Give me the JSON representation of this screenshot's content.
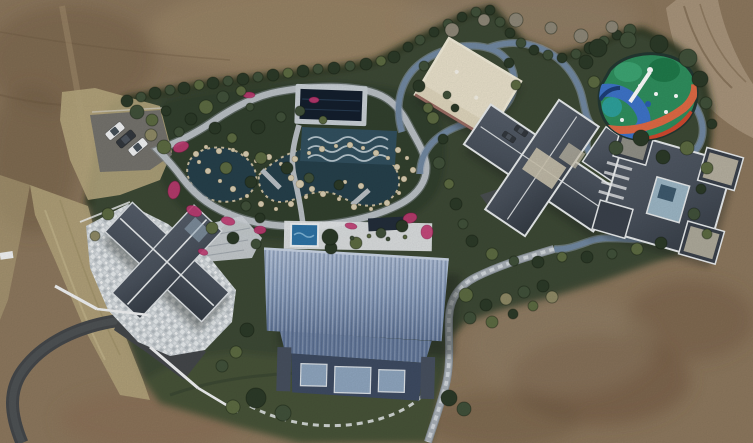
{
  "meta": {
    "type": "aerial-drone-photograph",
    "description": "Top-down drone view of a landscaped private estate surrounded by bare graded earth: a water garden with ponds and pink azaleas, a covered pool, a large blue metal-roof barn house, a slate-roof courtyard house with driveway and three parked cars, two dark hip-roof villas, a cream flat-roof pavilion, a colorful children's playground, winding grey and blue-grey paths, hedges and shrubs, a dirt road at top right and an asphalt road at bottom left."
  },
  "palette": {
    "dirt_base": "#8d785e",
    "dirt_light": "#a5906f",
    "dirt_dark": "#6b573f",
    "dirt_bottom": "#8a7057",
    "dirt_shadow": "#6e543c",
    "dirt_gray": "#94836c",
    "road_dirt": "#a8947b",
    "asphalt": "#44474a",
    "road_sheen": "#5c5f61",
    "parking": "#75736d",
    "grass_dry": "#b6a77e",
    "hedge": "#27321f",
    "green_base": "#3d4935",
    "green_dark": "#333f2d",
    "lawn": "#465339",
    "path_light": "#bac0c5",
    "path_blue": "#7289a2",
    "path_stone": "#aab1b8",
    "water": "#26404b",
    "wave_pool": "#32505f",
    "pool_cover": "#141f2d",
    "pool_frame": "#c9d0d5",
    "spa_blue": "#2e73a5",
    "roof_blue": "#8ba0c0",
    "roof_blue_light": "#a9bad4",
    "roof_blue_dark": "#64799c",
    "facade": "#3e4b62",
    "window_blue": "#8fa6bf",
    "slate": "#4a525d",
    "slate_dark": "#3a414b",
    "ridge": "#e9eced",
    "stone_pale": "#cfd5d9",
    "cream": "#e9e1cb",
    "cream_shade": "#d9cfb4",
    "glass": "#9db7c6",
    "tan_roof": "#ccc4af",
    "flower": "#c23a72",
    "rock": "#d7ccb1",
    "tree_dark": "#2c3a28",
    "tree_mid": "#41513a",
    "tree_olive": "#5d6b42",
    "tree_light": "#72814f",
    "tree_tan": "#8f8a66",
    "tree_bare": "#8e8878",
    "white": "#f2f3f4",
    "car_dark": "#33383e",
    "play_base": "#2f8f5e",
    "play_green": "#1f7a4a",
    "play_green2": "#3da573",
    "play_blue": "#3e74c9",
    "play_teal": "#2fa3a3",
    "play_orange": "#e06a45",
    "play_red": "#d0492f",
    "play_navy": "#1d3f7a"
  },
  "scene": {
    "regions": [
      "bare-earth",
      "dirt-road",
      "estate-garden",
      "water-garden",
      "covered-pool",
      "spa-deck",
      "blue-roof-barn",
      "courtyard-house",
      "villa-center",
      "villa-east",
      "cream-pavilion",
      "playground",
      "parking-lot",
      "asphalt-road",
      "south-lawn"
    ]
  },
  "vegetation": [
    [
      127,
      101,
      6,
      "dark"
    ],
    [
      141,
      97,
      5,
      "mid"
    ],
    [
      155,
      93,
      6,
      "dark"
    ],
    [
      170,
      90,
      5,
      "mid"
    ],
    [
      184,
      88,
      6,
      "dark"
    ],
    [
      199,
      85,
      5,
      "olive"
    ],
    [
      213,
      83,
      6,
      "dark"
    ],
    [
      228,
      81,
      5,
      "mid"
    ],
    [
      243,
      79,
      6,
      "dark"
    ],
    [
      258,
      77,
      5,
      "mid"
    ],
    [
      273,
      75,
      6,
      "dark"
    ],
    [
      288,
      73,
      5,
      "olive"
    ],
    [
      303,
      71,
      6,
      "dark"
    ],
    [
      318,
      69,
      5,
      "mid"
    ],
    [
      334,
      68,
      6,
      "dark"
    ],
    [
      350,
      66,
      5,
      "mid"
    ],
    [
      366,
      64,
      6,
      "dark"
    ],
    [
      381,
      61,
      5,
      "olive"
    ],
    [
      394,
      57,
      6,
      "dark"
    ],
    [
      408,
      47,
      5,
      "dark"
    ],
    [
      420,
      40,
      5,
      "mid"
    ],
    [
      434,
      32,
      5,
      "dark"
    ],
    [
      448,
      24,
      5,
      "mid"
    ],
    [
      462,
      17,
      5,
      "dark"
    ],
    [
      476,
      12,
      5,
      "mid"
    ],
    [
      490,
      10,
      5,
      "dark"
    ],
    [
      500,
      22,
      5,
      "mid"
    ],
    [
      510,
      33,
      5,
      "dark"
    ],
    [
      521,
      43,
      5,
      "mid"
    ],
    [
      534,
      50,
      5,
      "dark"
    ],
    [
      548,
      55,
      5,
      "mid"
    ],
    [
      562,
      58,
      5,
      "dark"
    ],
    [
      576,
      54,
      5,
      "mid"
    ],
    [
      590,
      48,
      6,
      "dark"
    ],
    [
      604,
      41,
      5,
      "mid"
    ],
    [
      617,
      35,
      5,
      "dark"
    ],
    [
      630,
      30,
      6,
      "mid"
    ],
    [
      452,
      30,
      7,
      "bare"
    ],
    [
      484,
      20,
      6,
      "bare"
    ],
    [
      516,
      20,
      7,
      "bare"
    ],
    [
      551,
      28,
      6,
      "bare"
    ],
    [
      581,
      36,
      7,
      "bare"
    ],
    [
      612,
      27,
      6,
      "bare"
    ],
    [
      137,
      112,
      7,
      "mid"
    ],
    [
      152,
      120,
      6,
      "olive"
    ],
    [
      166,
      111,
      5,
      "dark"
    ],
    [
      151,
      135,
      6,
      "tan"
    ],
    [
      164,
      147,
      7,
      "olive"
    ],
    [
      179,
      132,
      5,
      "mid"
    ],
    [
      191,
      119,
      6,
      "dark"
    ],
    [
      206,
      107,
      7,
      "olive"
    ],
    [
      223,
      97,
      6,
      "mid"
    ],
    [
      241,
      91,
      5,
      "olive"
    ],
    [
      215,
      128,
      6,
      "dark"
    ],
    [
      232,
      138,
      5,
      "olive"
    ],
    [
      258,
      127,
      7,
      "dark"
    ],
    [
      281,
      117,
      5,
      "mid"
    ],
    [
      261,
      158,
      6,
      "olive"
    ],
    [
      287,
      168,
      6,
      "dark"
    ],
    [
      309,
      178,
      5,
      "mid"
    ],
    [
      251,
      182,
      6,
      "dark"
    ],
    [
      226,
      168,
      6,
      "olive"
    ],
    [
      339,
      185,
      5,
      "dark"
    ],
    [
      300,
      111,
      5,
      "mid"
    ],
    [
      323,
      120,
      4,
      "olive"
    ],
    [
      212,
      228,
      6,
      "olive"
    ],
    [
      233,
      238,
      6,
      "dark"
    ],
    [
      256,
      244,
      5,
      "mid"
    ],
    [
      331,
      248,
      6,
      "dark"
    ],
    [
      356,
      243,
      6,
      "olive"
    ],
    [
      381,
      233,
      5,
      "mid"
    ],
    [
      402,
      226,
      6,
      "dark"
    ],
    [
      330,
      237,
      8,
      "dark"
    ],
    [
      352,
      238,
      2,
      "mid"
    ],
    [
      369,
      236,
      2,
      "olive"
    ],
    [
      388,
      239,
      2,
      "mid"
    ],
    [
      405,
      237,
      2,
      "olive"
    ],
    [
      433,
      118,
      6,
      "olive"
    ],
    [
      443,
      139,
      5,
      "dark"
    ],
    [
      439,
      163,
      6,
      "mid"
    ],
    [
      449,
      184,
      5,
      "olive"
    ],
    [
      456,
      204,
      6,
      "dark"
    ],
    [
      463,
      224,
      5,
      "mid"
    ],
    [
      424,
      66,
      5,
      "mid"
    ],
    [
      419,
      86,
      6,
      "dark"
    ],
    [
      428,
      108,
      5,
      "olive"
    ],
    [
      509,
      63,
      5,
      "dark"
    ],
    [
      516,
      85,
      5,
      "olive"
    ],
    [
      598,
      48,
      9,
      "dark"
    ],
    [
      628,
      40,
      8,
      "mid"
    ],
    [
      659,
      44,
      9,
      "dark"
    ],
    [
      688,
      58,
      9,
      "mid"
    ],
    [
      700,
      79,
      8,
      "dark"
    ],
    [
      641,
      138,
      8,
      "dark"
    ],
    [
      616,
      148,
      7,
      "mid"
    ],
    [
      663,
      157,
      7,
      "dark"
    ],
    [
      687,
      148,
      7,
      "olive"
    ],
    [
      586,
      62,
      7,
      "dark"
    ],
    [
      594,
      82,
      6,
      "olive"
    ],
    [
      706,
      103,
      6,
      "mid"
    ],
    [
      712,
      124,
      5,
      "dark"
    ],
    [
      707,
      168,
      6,
      "olive"
    ],
    [
      701,
      189,
      5,
      "dark"
    ],
    [
      694,
      214,
      6,
      "mid"
    ],
    [
      707,
      234,
      5,
      "olive"
    ],
    [
      472,
      241,
      6,
      "dark"
    ],
    [
      492,
      254,
      6,
      "olive"
    ],
    [
      514,
      261,
      5,
      "mid"
    ],
    [
      538,
      262,
      6,
      "dark"
    ],
    [
      562,
      257,
      5,
      "olive"
    ],
    [
      587,
      257,
      6,
      "dark"
    ],
    [
      612,
      254,
      5,
      "mid"
    ],
    [
      637,
      249,
      6,
      "olive"
    ],
    [
      661,
      243,
      6,
      "dark"
    ],
    [
      466,
      295,
      7,
      "olive"
    ],
    [
      486,
      305,
      6,
      "dark"
    ],
    [
      506,
      299,
      6,
      "tan"
    ],
    [
      524,
      292,
      6,
      "mid"
    ],
    [
      543,
      286,
      6,
      "dark"
    ],
    [
      470,
      318,
      6,
      "mid"
    ],
    [
      492,
      322,
      6,
      "olive"
    ],
    [
      513,
      314,
      5,
      "dark"
    ],
    [
      533,
      306,
      5,
      "olive"
    ],
    [
      552,
      297,
      6,
      "tan"
    ],
    [
      256,
      398,
      10,
      "dark"
    ],
    [
      283,
      413,
      8,
      "mid"
    ],
    [
      233,
      407,
      7,
      "olive"
    ],
    [
      449,
      398,
      8,
      "dark"
    ],
    [
      464,
      409,
      7,
      "mid"
    ],
    [
      108,
      214,
      6,
      "olive"
    ],
    [
      95,
      236,
      5,
      "tan"
    ],
    [
      246,
      206,
      5,
      "mid"
    ],
    [
      260,
      218,
      5,
      "dark"
    ],
    [
      247,
      330,
      7,
      "dark"
    ],
    [
      236,
      352,
      6,
      "olive"
    ],
    [
      222,
      366,
      6,
      "mid"
    ],
    [
      250,
      107,
      4,
      "mid"
    ],
    [
      447,
      95,
      4,
      "mid"
    ],
    [
      455,
      108,
      4,
      "dark"
    ]
  ],
  "rocks": [
    [
      196,
      154,
      3
    ],
    [
      206,
      147,
      2
    ],
    [
      219,
      151,
      3
    ],
    [
      233,
      150,
      2
    ],
    [
      246,
      154,
      3
    ],
    [
      256,
      161,
      2
    ],
    [
      269,
      157,
      3
    ],
    [
      281,
      164,
      2
    ],
    [
      295,
      159,
      3
    ],
    [
      309,
      153,
      2
    ],
    [
      322,
      149,
      3
    ],
    [
      336,
      146,
      2
    ],
    [
      350,
      145,
      3
    ],
    [
      363,
      148,
      2
    ],
    [
      376,
      153,
      3
    ],
    [
      388,
      158,
      2
    ],
    [
      397,
      167,
      3
    ],
    [
      404,
      179,
      3
    ],
    [
      399,
      193,
      2
    ],
    [
      387,
      203,
      3
    ],
    [
      371,
      209,
      2
    ],
    [
      354,
      207,
      3
    ],
    [
      339,
      199,
      2
    ],
    [
      323,
      194,
      3
    ],
    [
      306,
      197,
      2
    ],
    [
      291,
      204,
      3
    ],
    [
      276,
      209,
      2
    ],
    [
      261,
      204,
      3
    ],
    [
      247,
      196,
      2
    ],
    [
      233,
      189,
      3
    ],
    [
      220,
      181,
      2
    ],
    [
      208,
      171,
      3
    ],
    [
      199,
      162,
      2
    ],
    [
      300,
      184,
      4
    ],
    [
      312,
      189,
      3
    ],
    [
      291,
      178,
      3
    ],
    [
      398,
      150,
      3
    ],
    [
      407,
      158,
      2
    ],
    [
      413,
      170,
      3
    ],
    [
      361,
      186,
      3
    ],
    [
      345,
      182,
      2
    ]
  ],
  "flowers": [
    [
      181,
      147,
      8,
      5,
      -20
    ],
    [
      174,
      190,
      6,
      9,
      10
    ],
    [
      194,
      211,
      8,
      5,
      25
    ],
    [
      228,
      221,
      7,
      4,
      15
    ],
    [
      260,
      230,
      6,
      4,
      0
    ],
    [
      410,
      218,
      7,
      5,
      -15
    ],
    [
      427,
      232,
      6,
      7,
      0
    ],
    [
      249,
      95,
      6,
      3,
      0
    ],
    [
      351,
      226,
      6,
      3,
      10
    ],
    [
      314,
      100,
      5,
      3,
      0
    ],
    [
      203,
      252,
      5,
      3,
      20
    ]
  ],
  "vehicles": [
    {
      "x": 115,
      "y": 131,
      "a": -40,
      "c": "white",
      "s": 1
    },
    {
      "x": 126,
      "y": 139,
      "a": -40,
      "c": "dark",
      "s": 1
    },
    {
      "x": 138,
      "y": 147,
      "a": -40,
      "c": "white",
      "s": 1
    },
    {
      "x": 509,
      "y": 137,
      "a": 34,
      "c": "dark",
      "s": 0.7
    },
    {
      "x": 521,
      "y": 131,
      "a": 34,
      "c": "dark",
      "s": 0.7
    }
  ]
}
